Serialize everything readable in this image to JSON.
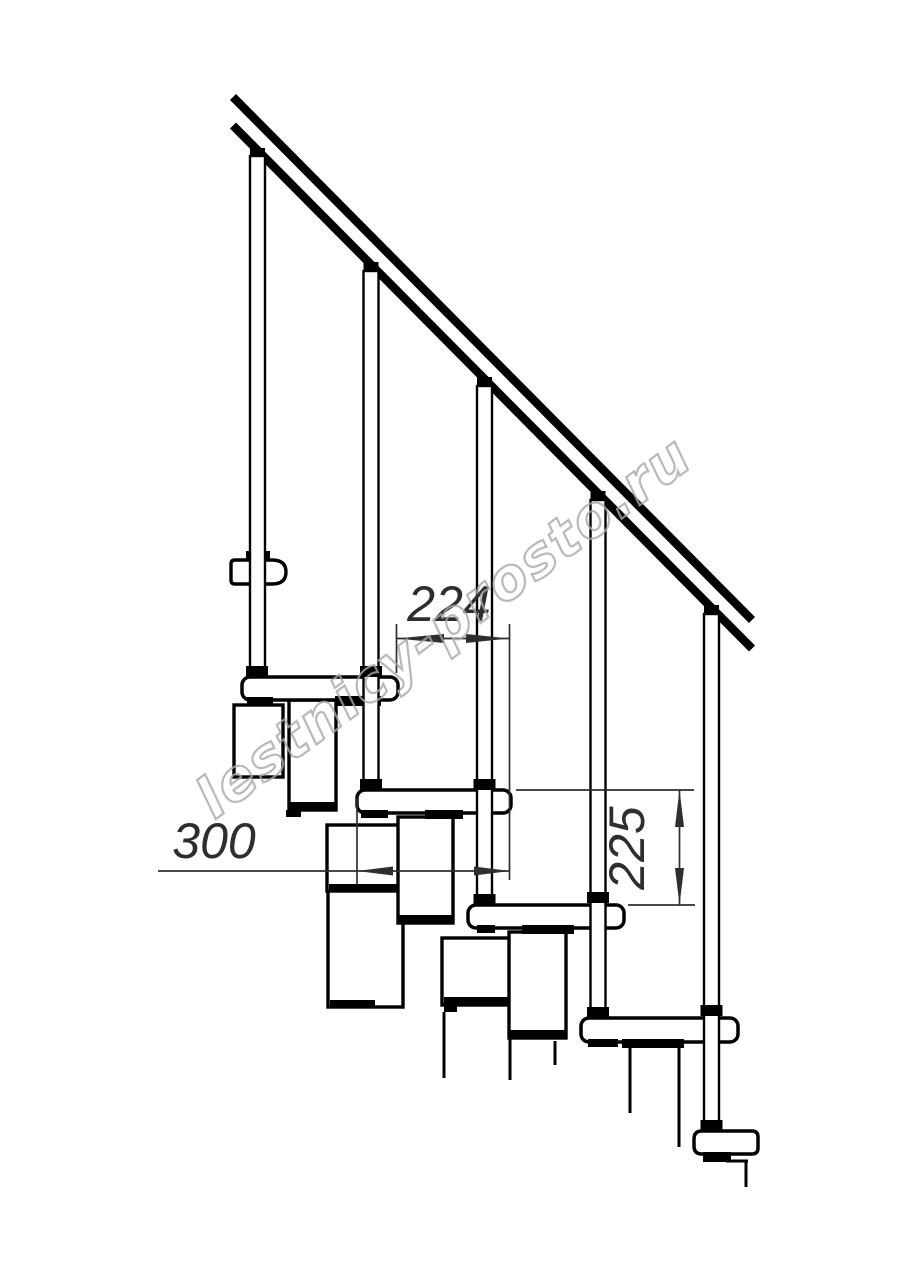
{
  "drawing": {
    "kind": "modular-staircase-side-view",
    "watermark": "lestnicy-prosto.ru",
    "dimensions": {
      "run": "224",
      "tread_depth": "300",
      "rise": "225"
    },
    "colors": {
      "background": "#ffffff",
      "line": "#000000",
      "dimension": "#2e2e2e",
      "watermark": "#a8a8a8"
    }
  }
}
